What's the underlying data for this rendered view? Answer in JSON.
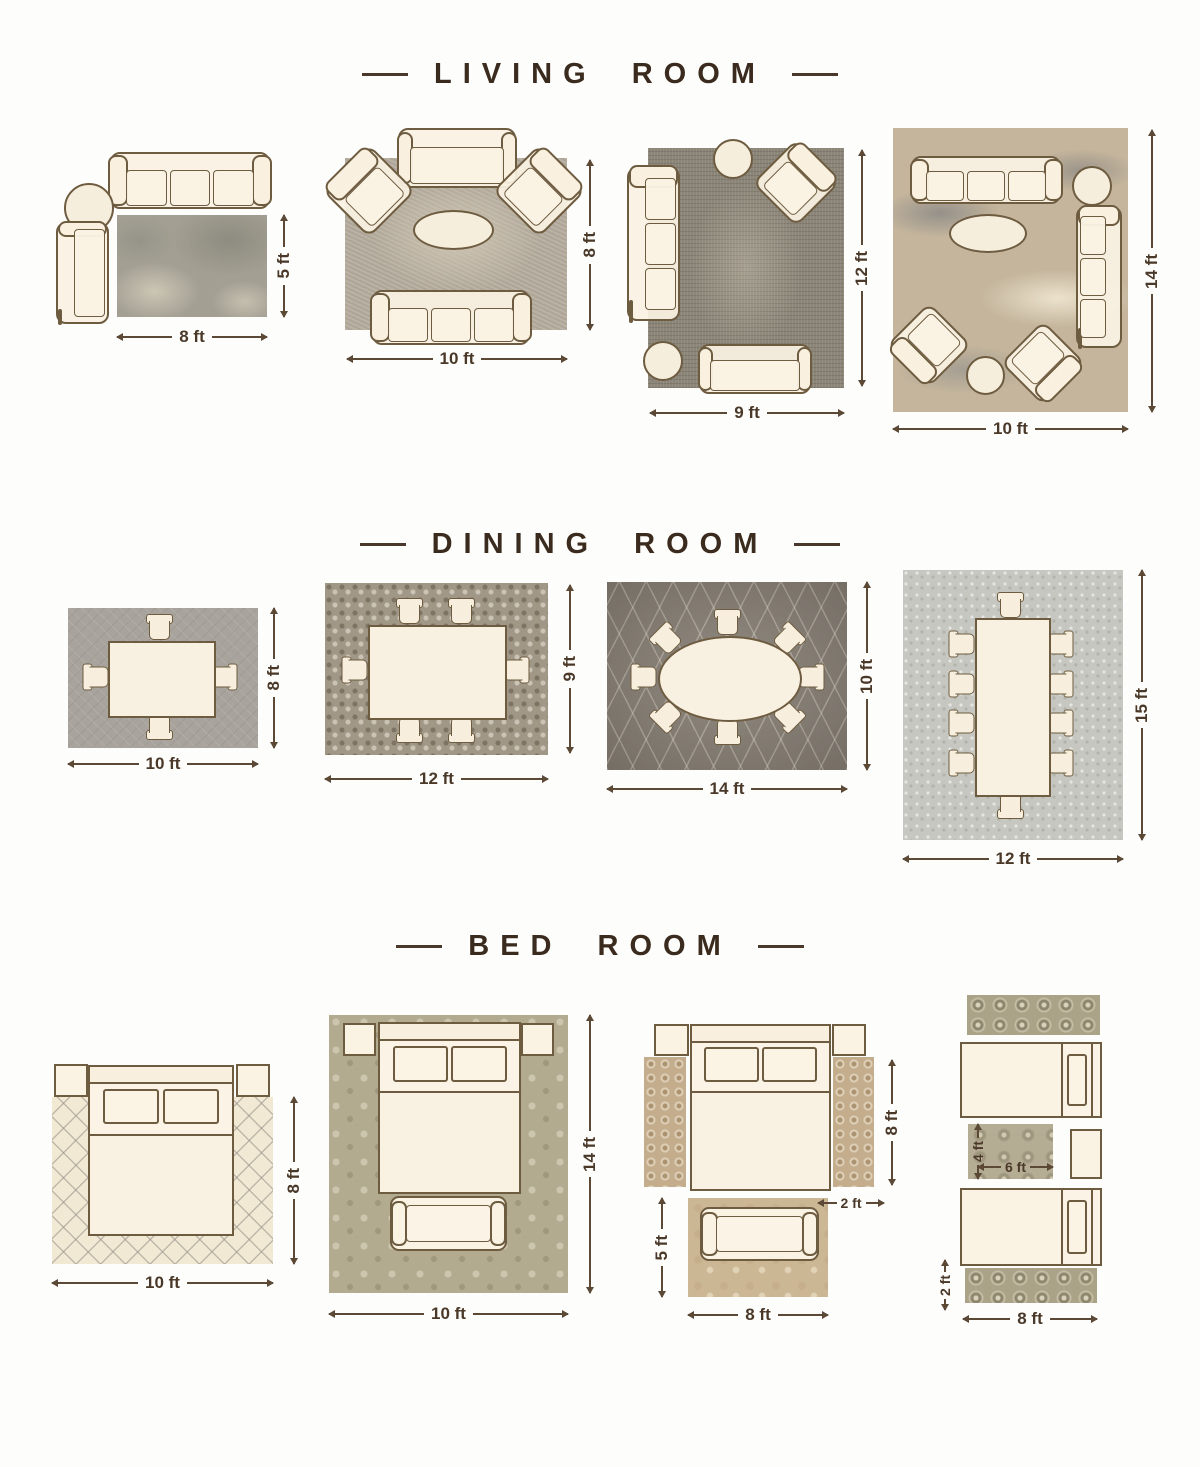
{
  "sections": [
    {
      "title": "LIVING ROOM",
      "layouts": [
        {
          "id": "living-8x5",
          "width_label": "8 ft",
          "height_label": "5 ft",
          "rug": "distressed-gray",
          "furniture": [
            "three-seat-sofa",
            "round-side-table",
            "chaise"
          ]
        },
        {
          "id": "living-10x8",
          "width_label": "10 ft",
          "height_label": "8 ft",
          "rug": "textured-taupe",
          "furniture": [
            "loveseat",
            "armchair",
            "armchair",
            "oval-coffee-table",
            "three-seat-sofa"
          ]
        },
        {
          "id": "living-9x12",
          "width_label": "9 ft",
          "height_label": "12 ft",
          "rug": "vintage-charcoal",
          "furniture": [
            "three-seat-sofa",
            "round-side-table",
            "armchair",
            "round-side-table",
            "loveseat"
          ]
        },
        {
          "id": "living-10x14",
          "width_label": "10 ft",
          "height_label": "14 ft",
          "rug": "abstract-beige",
          "furniture": [
            "three-seat-sofa",
            "round-side-table",
            "three-seat-sofa",
            "oval-coffee-table",
            "armchair",
            "armchair",
            "round-side-table"
          ]
        }
      ]
    },
    {
      "title": "DINING ROOM",
      "layouts": [
        {
          "id": "dining-10x8",
          "width_label": "10 ft",
          "height_label": "8 ft",
          "seats": 4
        },
        {
          "id": "dining-12x9",
          "width_label": "12 ft",
          "height_label": "9 ft",
          "seats": 6
        },
        {
          "id": "dining-14x10",
          "width_label": "14 ft",
          "height_label": "10 ft",
          "seats": 8
        },
        {
          "id": "dining-12x15",
          "width_label": "12 ft",
          "height_label": "15 ft",
          "seats": 10
        }
      ]
    },
    {
      "title": "BED ROOM",
      "layouts": [
        {
          "id": "bed-10x8",
          "width_label": "10 ft",
          "height_label": "8 ft",
          "furniture": [
            "queen-bed",
            "nightstand",
            "nightstand"
          ]
        },
        {
          "id": "bed-10x14",
          "width_label": "10 ft",
          "height_label": "14 ft",
          "furniture": [
            "queen-bed",
            "nightstand",
            "nightstand",
            "bench"
          ]
        },
        {
          "id": "bed-queen-runners",
          "runner_height_label": "8 ft",
          "runner_width_label": "2 ft",
          "rug_width_label": "8 ft",
          "rug_height_label": "5 ft",
          "furniture": [
            "queen-bed",
            "nightstand",
            "nightstand",
            "runner-rug",
            "runner-rug",
            "bench"
          ]
        },
        {
          "id": "bed-twin-runners",
          "small_rug_height_label": "4 ft",
          "small_rug_width_label": "6 ft",
          "runner_height_label": "2 ft",
          "runner_width_label": "8 ft",
          "furniture": [
            "twin-bed",
            "twin-bed",
            "nightstand",
            "runner-rug",
            "runner-rug",
            "small-rug"
          ]
        }
      ]
    }
  ],
  "colors": {
    "heading_text": "#3a2b1e",
    "dimension_text": "#4a3828",
    "dimension_line": "#5b4936",
    "furniture_fill": "#f9f0df",
    "furniture_outline": "#6e5c40"
  }
}
